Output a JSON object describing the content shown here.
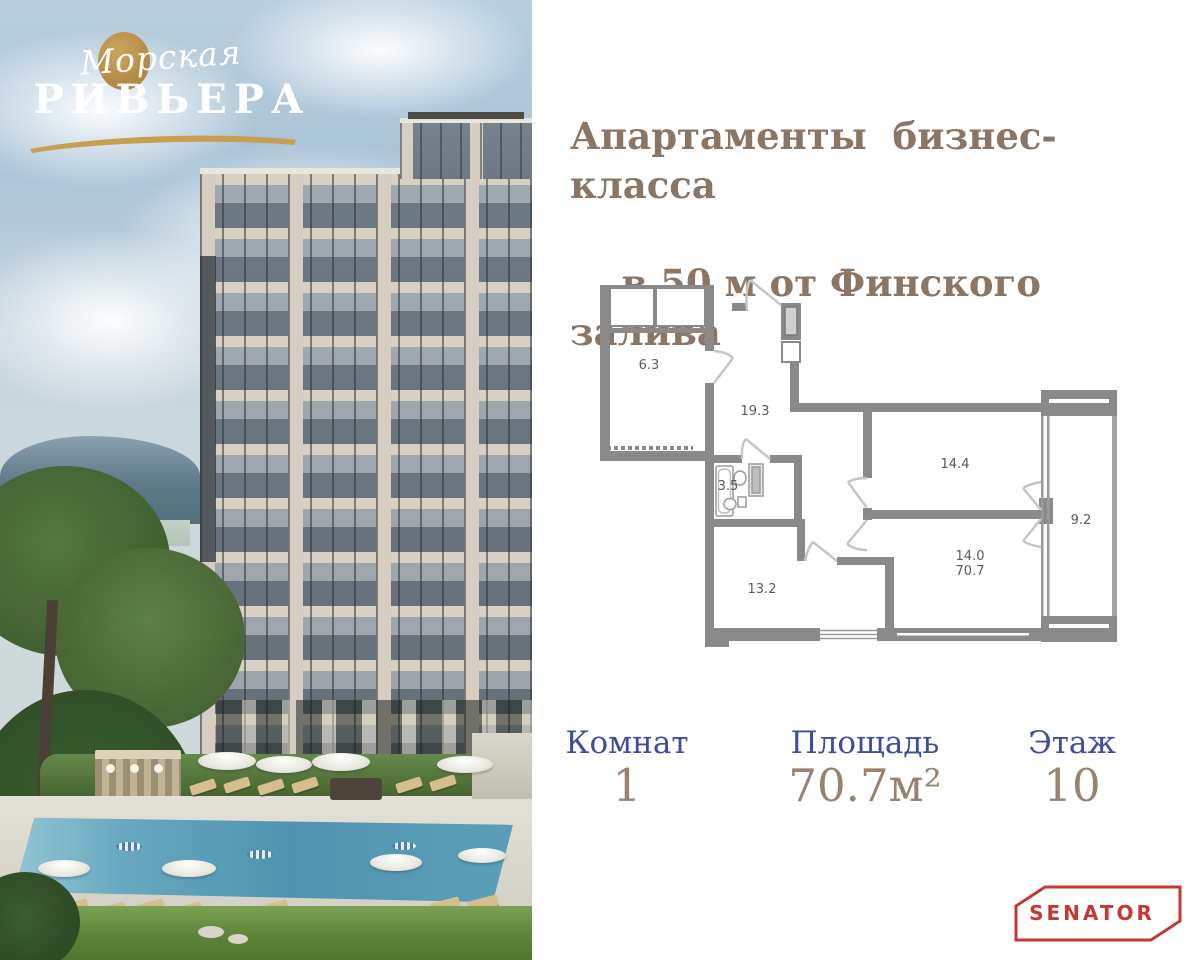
{
  "brand": {
    "script_word": "Морская",
    "name_word": "РИВЬЕРА"
  },
  "headline": {
    "line1": "Апартаменты  бизнес-класса",
    "line2": "в 50 м от Финского залива"
  },
  "plan": {
    "rooms": [
      {
        "name": "entry-room",
        "area": "6.3"
      },
      {
        "name": "hall",
        "area": "19.3"
      },
      {
        "name": "bathroom",
        "area": "3.5"
      },
      {
        "name": "kitchen-living",
        "area": "14.4"
      },
      {
        "name": "bedroom",
        "area": "14.0"
      },
      {
        "name": "total-area",
        "area": "70.7"
      },
      {
        "name": "balcony",
        "area": "9.2"
      },
      {
        "name": "room",
        "area": "13.2"
      }
    ]
  },
  "info": {
    "cards": [
      {
        "label": "Комнат",
        "value": "1"
      },
      {
        "label": "Площадь",
        "value": "70.7м²"
      },
      {
        "label": "Этаж",
        "value": "10"
      }
    ]
  },
  "developer": {
    "logo_text": "SENATOR"
  },
  "colors": {
    "headline_brown": "#8B7565",
    "label_blue": "#3E4E9C",
    "value_brown": "#9A8170",
    "logo_gold": "#C79F4E",
    "senator_red": "#C23A32",
    "plan_wall_gray": "#8A8A8A"
  }
}
